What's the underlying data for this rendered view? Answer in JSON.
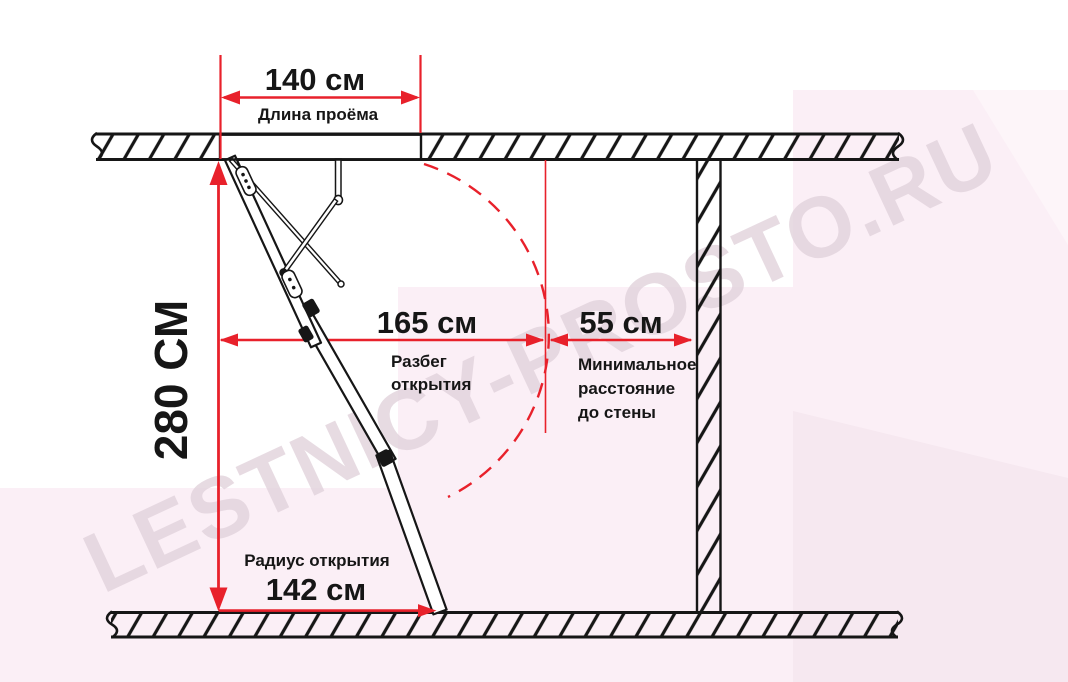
{
  "diagram": {
    "watermark": "LESTNICY-PROSTO.RU",
    "dims": {
      "opening_length": {
        "value": "140 см",
        "label": "Длина проёма"
      },
      "height": {
        "value": "280 СМ"
      },
      "span": {
        "value": "165 см",
        "label_1": "Разбег",
        "label_2": "открытия"
      },
      "wall_distance": {
        "value": "55 см",
        "label_1": "Минимальное",
        "label_2": "расстояние",
        "label_3": "до стены"
      },
      "radius": {
        "value": "142 см",
        "label": "Радиус открытия"
      }
    },
    "colors": {
      "accent_red": "#e8212b",
      "line_black": "#161616",
      "bg_pink_main": "#fbeff6",
      "bg_pink_dark": "#f6e8f0",
      "bg_pink_lighter": "#fdf5f9",
      "watermark_color": "#e2d3dc"
    }
  }
}
